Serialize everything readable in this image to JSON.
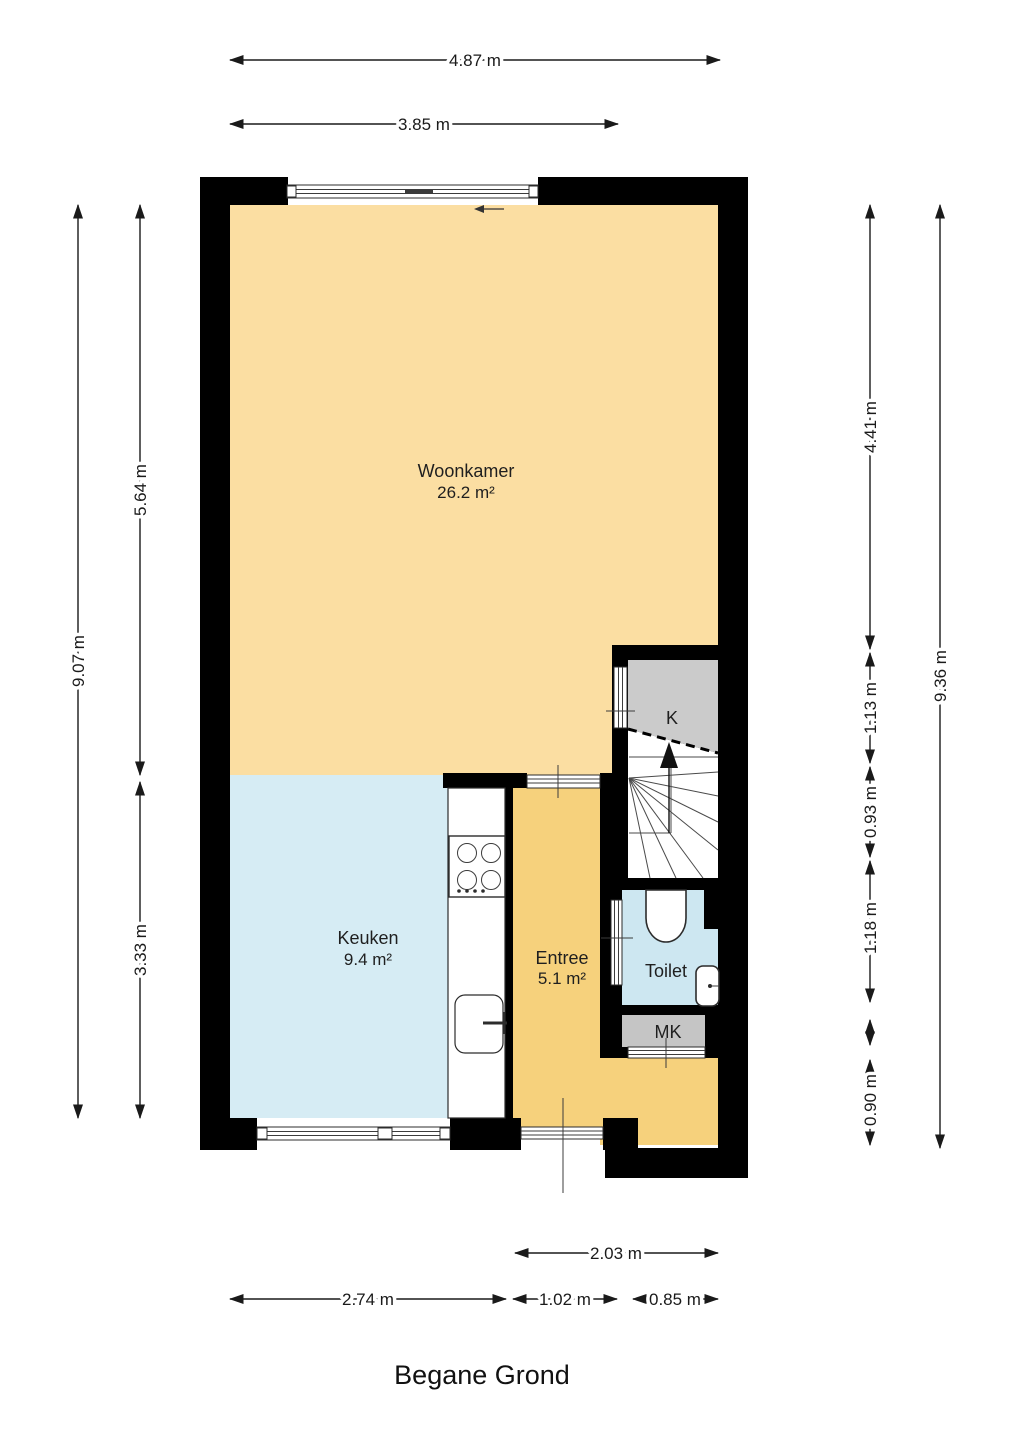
{
  "title": "Begane Grond",
  "rooms": {
    "woonkamer": {
      "name": "Woonkamer",
      "area": "26.2 m²"
    },
    "keuken": {
      "name": "Keuken",
      "area": "9.4 m²"
    },
    "entree": {
      "name": "Entree",
      "area": "5.1 m²"
    },
    "toilet": {
      "name": "Toilet"
    },
    "kast": {
      "name": "K"
    },
    "meterkast": {
      "name": "MK"
    }
  },
  "dimensions": {
    "top": [
      "4.87 m",
      "3.85 m"
    ],
    "left": [
      "9.07 m",
      "5.64 m",
      "3.33 m"
    ],
    "right": [
      "9.36 m",
      "4.41 m",
      "1.13 m",
      "0.93 m",
      "1.18 m",
      "0.90 m"
    ],
    "bottom": [
      "2.03 m",
      "2.74 m",
      "1.02 m",
      "0.85 m"
    ]
  },
  "icons": {
    "stairs_direction": "arrow-up",
    "sliding_door_direction": "arrow-left"
  },
  "colors": {
    "woonkamer": "#FBDEA2",
    "entree": "#F6D17C",
    "keuken": "#D6ECF4",
    "toilet": "#CDE7F1",
    "kast": "#CBCBCB",
    "meterkast": "#C5C5C5",
    "wall": "#000000"
  }
}
